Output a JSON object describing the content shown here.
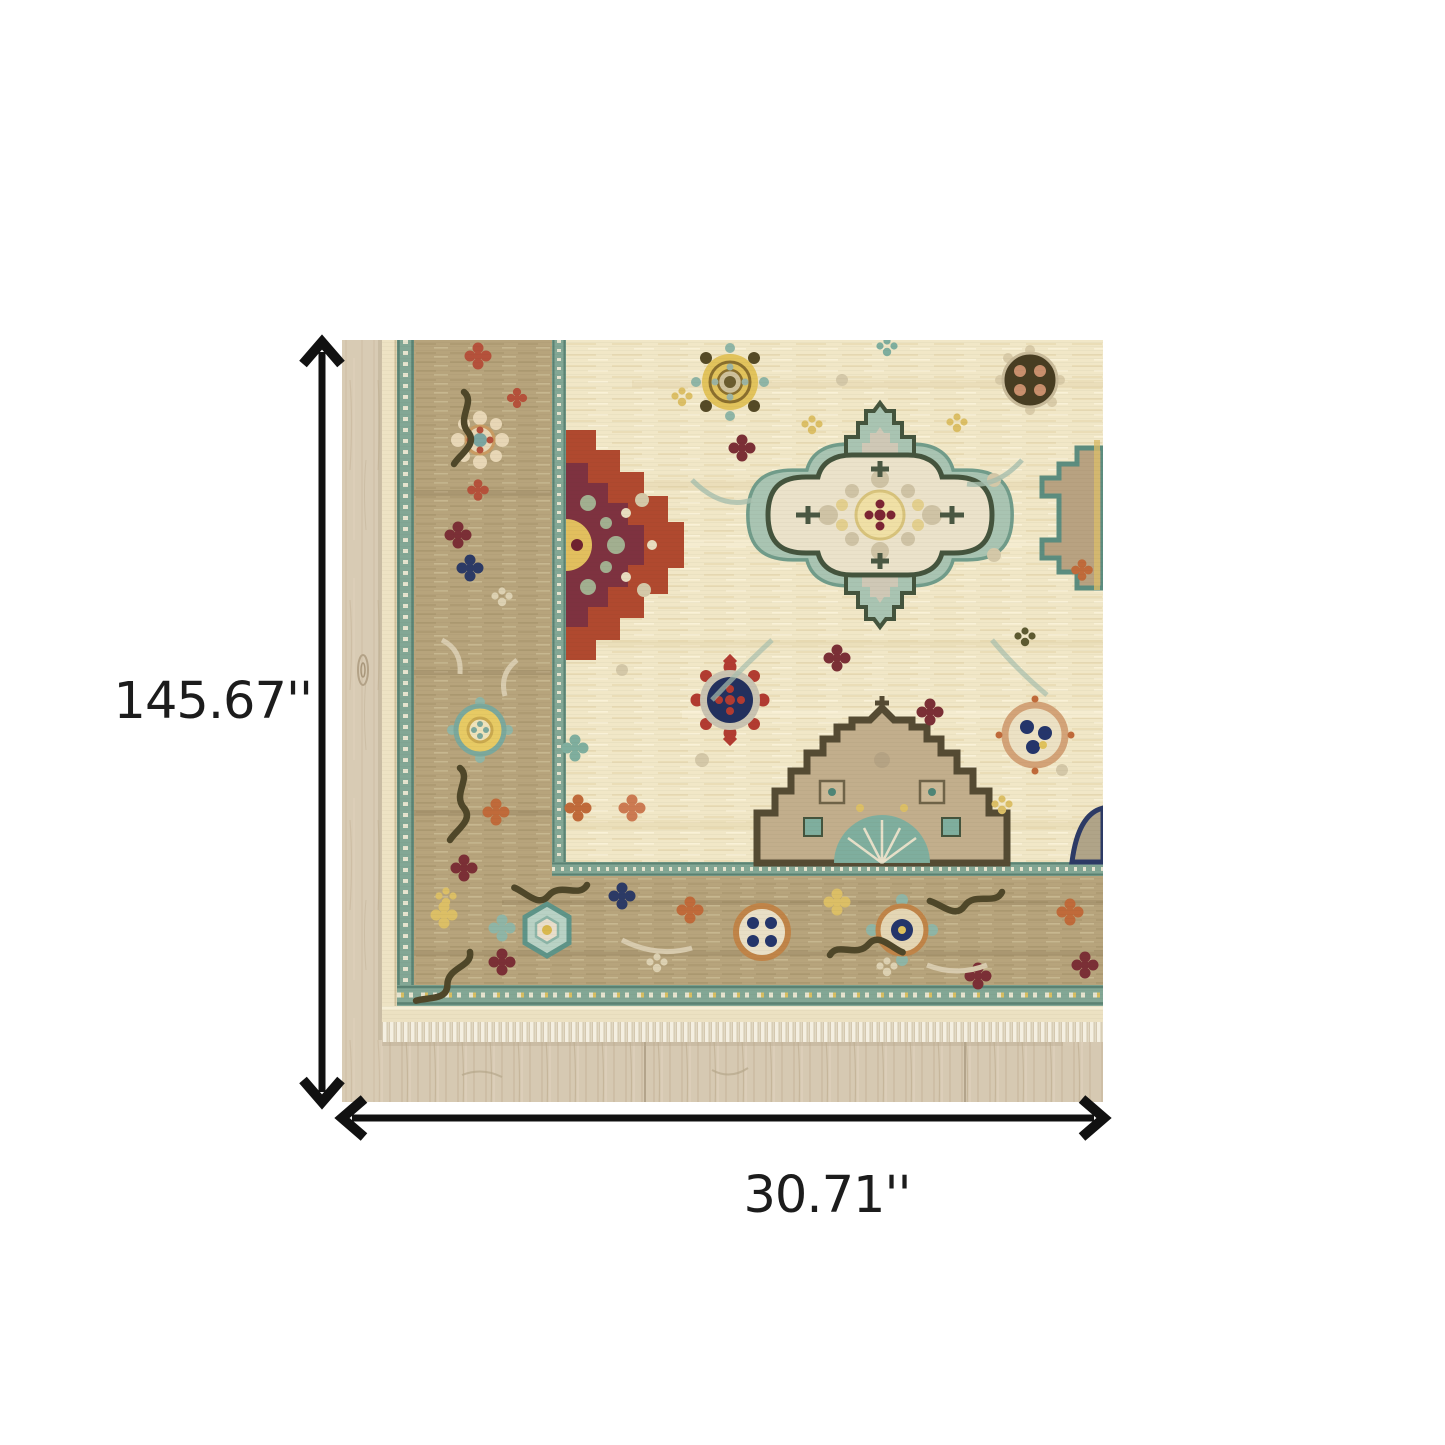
{
  "figure": {
    "height_label": "145.67''",
    "width_label": "30.71''",
    "arrow_color": "#111111",
    "label_color": "#1c1c1c",
    "background_color": "#ffffff",
    "icons": {
      "height_arrow": "double-headed-vertical-arrow-icon",
      "width_arrow": "double-headed-horizontal-arrow-icon"
    }
  },
  "photo": {
    "subject": "oriental-rug-corner-on-light-wood-floor",
    "palette": {
      "floor_wood": "#d6c9b2",
      "floor_grain": "#c0af93",
      "rug_field_ivory": "#f1e7c7",
      "rug_border_tan": "#b7a47c",
      "guard_stripe_teal": "#83a795",
      "medallion_rust_red": "#b0492f",
      "medallion_maroon": "#7e3240",
      "medallion_teal_halo": "#a9c4b2",
      "medallion_outline_olive": "#44543d",
      "accent_navy": "#22305e",
      "accent_yellow": "#e2c35c",
      "accent_orange": "#c08448",
      "accent_sage": "#a2af90",
      "fringe_white": "#f4efe1"
    }
  }
}
